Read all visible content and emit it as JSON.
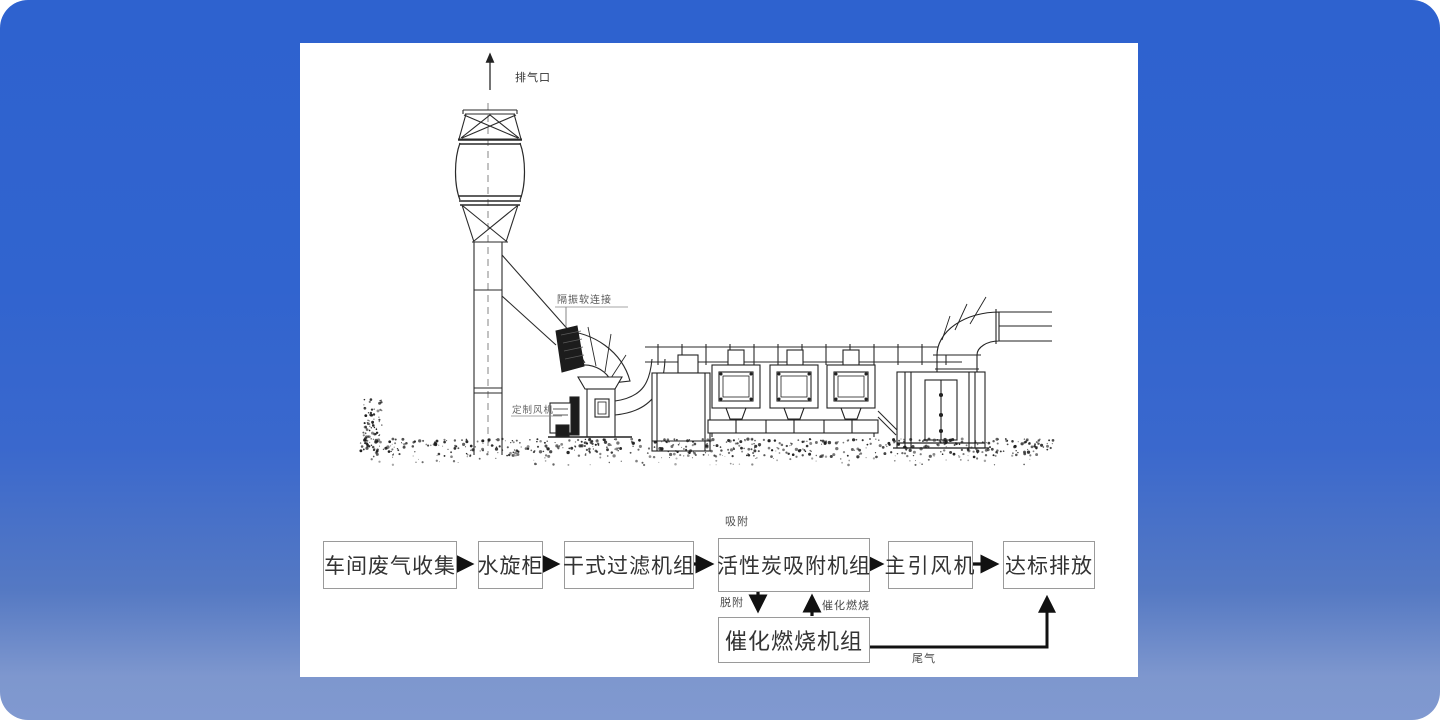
{
  "colors": {
    "background_top": "#2e62cf",
    "background_bottom": "#8099d0",
    "panel": "#ffffff",
    "line": "#222222",
    "box_border": "#9a9a9a",
    "box_text": "#333333",
    "arrow": "#111111"
  },
  "drawing": {
    "exhaust_outlet_label": "排气口",
    "soft_connection_label": "隔振软连接",
    "fan_label": "定制风机"
  },
  "flowchart": {
    "boxes": [
      {
        "label": "车间废气收集"
      },
      {
        "label": "水旋柜"
      },
      {
        "label": "干式过滤机组"
      },
      {
        "label": "活性炭吸附机组"
      },
      {
        "label": "主引风机"
      },
      {
        "label": "达标排放"
      }
    ],
    "combustion_box_label": "催化燃烧机组",
    "adsorption_label": "吸附",
    "desorption_label": "脱附",
    "catalytic_combustion_label": "催化燃烧",
    "tail_gas_label": "尾气"
  }
}
